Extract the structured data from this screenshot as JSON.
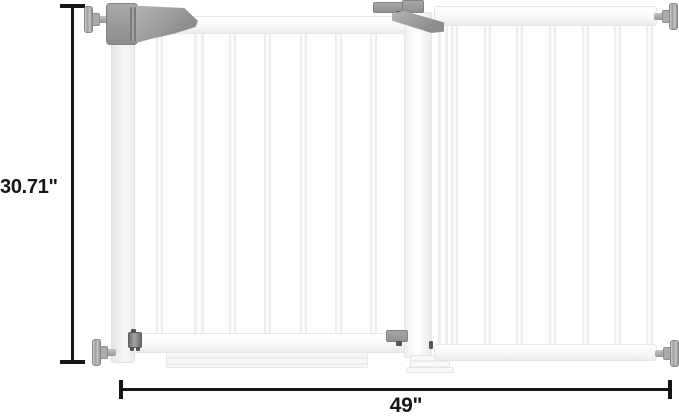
{
  "figure": {
    "description": "Two-panel white pressure-mounted baby safety gate shown with dimension lines",
    "height_label": "30.71\"",
    "width_label": "49\""
  },
  "colors": {
    "background": "#ffffff",
    "dimension_line": "#161616",
    "gate_fill": "#ffffff",
    "gate_outline": "#e8e8e8",
    "hardware_gray": "#9a9a9a",
    "hardware_dark": "#6b6b6b"
  }
}
